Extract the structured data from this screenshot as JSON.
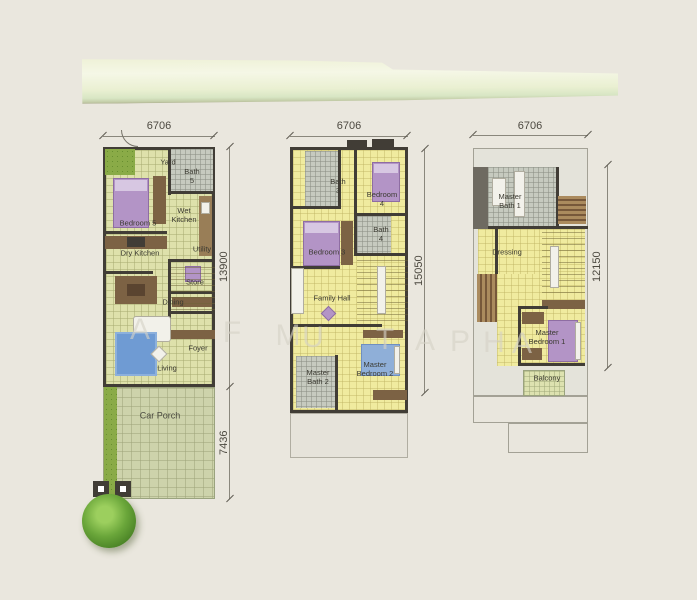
{
  "page": {
    "background_color": "#eae7de"
  },
  "watermark": {
    "letters": [
      "A",
      "F",
      "M",
      "U",
      "T",
      "A",
      "P",
      "H",
      "A"
    ]
  },
  "plans": [
    {
      "title": "ground-floor-plan",
      "dimensions": {
        "width": "6706",
        "height_main": "13900",
        "height_porch": "7436"
      },
      "rooms": {
        "yard": "Yard",
        "bath5": "Bath\n5",
        "bedroom5": "Bedroom 5",
        "wet_kitchen": "Wet\nKitchen",
        "dry_kitchen": "Dry Kitchen",
        "utility": "Utility",
        "store": "Store",
        "dining": "Dining",
        "foyer": "Foyer",
        "living": "Living",
        "car_porch": "Car Porch"
      }
    },
    {
      "title": "first-floor-plan",
      "dimensions": {
        "width": "6706",
        "height": "15050"
      },
      "rooms": {
        "bath3": "Bath\n3",
        "bedroom4": "Bedroom\n4",
        "bath4": "Bath\n4",
        "bedroom3": "Bedroom 3",
        "family_hall": "Family Hall",
        "master_bath2": "Master\nBath 2",
        "master_bedroom2": "Master\nBedroom 2"
      }
    },
    {
      "title": "second-floor-plan",
      "dimensions": {
        "width": "6706",
        "height": "12150"
      },
      "rooms": {
        "master_bath1": "Master\nBath 1",
        "dressing": "Dressing",
        "master_bedroom1": "Master\nBedroom 1",
        "balcony": "Balcony"
      }
    }
  ],
  "colors": {
    "floor_ground": "#dee1ab",
    "floor_upper": "#f0eb9f",
    "car_porch": "#cdd3ab",
    "bath_tile": "#c6cabf",
    "wall": "#413d36",
    "bed_purple": "#b394c6",
    "bed_blue": "#8fafd8",
    "rug_blue": "#6f9bd3",
    "grass": "#8aab47"
  }
}
